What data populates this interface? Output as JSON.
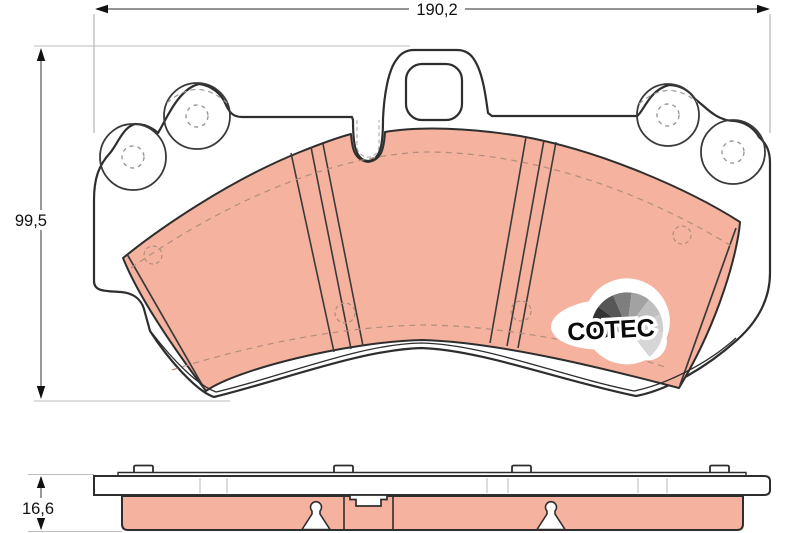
{
  "drawing": {
    "type": "brake-pad-technical-drawing",
    "dimensions": {
      "width": "190,2",
      "height": "99,5",
      "thickness": "16,6"
    },
    "logo_text": "COTEC",
    "colors": {
      "friction": "#f5b29e",
      "outline": "#2e2e2e",
      "thin_line": "#444444",
      "dimension_line": "#a6a6a6",
      "dimension_text": "#111111",
      "hidden_dash": "#b08e7d",
      "faint_tick": "#d0d0d0",
      "background": "#ffffff",
      "fan": [
        "#0d0d0d",
        "#343434",
        "#575757",
        "#7e7e7e",
        "#a2a2a2",
        "#bfbfbf",
        "#cfcfcf",
        "#d6d6d6"
      ]
    }
  }
}
